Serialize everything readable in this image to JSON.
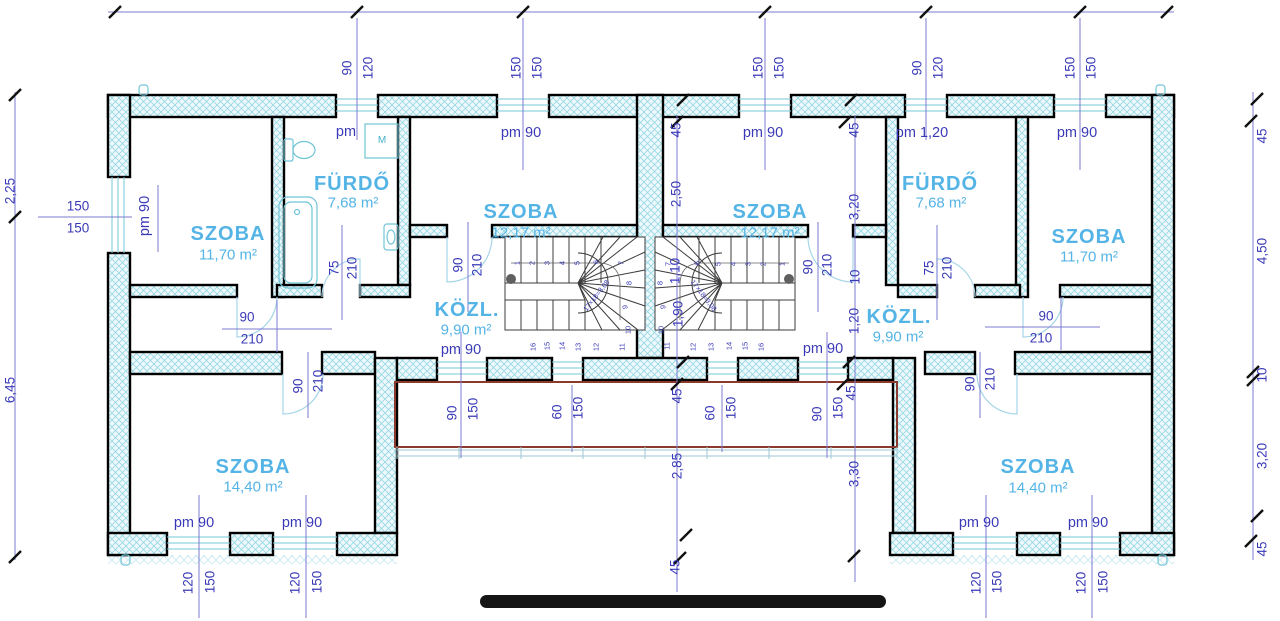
{
  "drawing": {
    "kind": "architectural floor plan",
    "language": "Hungarian",
    "rooms": [
      {
        "name": "SZOBA",
        "area": "11,70 m²"
      },
      {
        "name": "FÜRDŐ",
        "area": "7,68 m²"
      },
      {
        "name": "SZOBA",
        "area": "12,17 m²"
      },
      {
        "name": "KÖZL.",
        "area": "9,90 m²"
      },
      {
        "name": "SZOBA",
        "area": "12,17 m²"
      },
      {
        "name": "KÖZL.",
        "area": "9,90 m²"
      },
      {
        "name": "FÜRDŐ",
        "area": "7,68 m²"
      },
      {
        "name": "SZOBA",
        "area": "11,70 m²"
      },
      {
        "name": "SZOBA",
        "area": "14,40 m²"
      },
      {
        "name": "SZOBA",
        "area": "14,40 m²"
      }
    ],
    "colors": {
      "dimension_text": "#3a3ab8",
      "room_text": "#54b4e6",
      "terrace_outline": "#8a3b2e",
      "wall_hatch": "#96d7e4"
    }
  },
  "labels": [
    {
      "t": "90",
      "x": 347,
      "y": 68,
      "r": -90,
      "c": "dim"
    },
    {
      "t": "120",
      "x": 368,
      "y": 68,
      "r": -90,
      "c": "dim"
    },
    {
      "t": "150",
      "x": 516,
      "y": 68,
      "r": -90,
      "c": "dim"
    },
    {
      "t": "150",
      "x": 537,
      "y": 68,
      "r": -90,
      "c": "dim"
    },
    {
      "t": "150",
      "x": 758,
      "y": 68,
      "r": -90,
      "c": "dim"
    },
    {
      "t": "150",
      "x": 779,
      "y": 68,
      "r": -90,
      "c": "dim"
    },
    {
      "t": "90",
      "x": 917,
      "y": 68,
      "r": -90,
      "c": "dim"
    },
    {
      "t": "120",
      "x": 938,
      "y": 68,
      "r": -90,
      "c": "dim"
    },
    {
      "t": "150",
      "x": 1070,
      "y": 68,
      "r": -90,
      "c": "dim"
    },
    {
      "t": "150",
      "x": 1091,
      "y": 68,
      "r": -90,
      "c": "dim"
    },
    {
      "t": "pm",
      "x": 346,
      "y": 132,
      "c": "pm"
    },
    {
      "t": "pm 90",
      "x": 521,
      "y": 133,
      "c": "pm"
    },
    {
      "t": "pm 90",
      "x": 763,
      "y": 133,
      "c": "pm"
    },
    {
      "t": "pm 1,20",
      "x": 922,
      "y": 133,
      "c": "pm"
    },
    {
      "t": "pm 90",
      "x": 1077,
      "y": 133,
      "c": "pm"
    },
    {
      "t": "pm 90",
      "x": 461,
      "y": 350,
      "c": "pm"
    },
    {
      "t": "pm 90",
      "x": 823,
      "y": 349,
      "c": "pm"
    },
    {
      "t": "pm 90",
      "x": 194,
      "y": 523,
      "c": "pm"
    },
    {
      "t": "pm 90",
      "x": 302,
      "y": 523,
      "c": "pm"
    },
    {
      "t": "pm 90",
      "x": 979,
      "y": 523,
      "c": "pm"
    },
    {
      "t": "pm 90",
      "x": 1088,
      "y": 523,
      "c": "pm"
    },
    {
      "t": "45",
      "x": 676,
      "y": 130,
      "r": -90,
      "c": "dim"
    },
    {
      "t": "45",
      "x": 854,
      "y": 130,
      "r": -90,
      "c": "dim"
    },
    {
      "t": "45",
      "x": 677,
      "y": 396,
      "r": -90,
      "c": "dim"
    },
    {
      "t": "45",
      "x": 851,
      "y": 393,
      "r": -90,
      "c": "dim"
    },
    {
      "t": "45",
      "x": 675,
      "y": 567,
      "r": -90,
      "c": "dim"
    },
    {
      "t": "45",
      "x": 1262,
      "y": 136,
      "r": -90,
      "c": "dim"
    },
    {
      "t": "4,50",
      "x": 1262,
      "y": 251,
      "r": -90,
      "c": "dim"
    },
    {
      "t": "10",
      "x": 1262,
      "y": 375,
      "r": -90,
      "c": "dim"
    },
    {
      "t": "3,20",
      "x": 1262,
      "y": 456,
      "r": -90,
      "c": "dim"
    },
    {
      "t": "45",
      "x": 1262,
      "y": 549,
      "r": -90,
      "c": "dim"
    },
    {
      "t": "2,25",
      "x": 10,
      "y": 191,
      "r": -90,
      "c": "dim"
    },
    {
      "t": "6,45",
      "x": 10,
      "y": 390,
      "r": -90,
      "c": "dim"
    },
    {
      "t": "150",
      "x": 78,
      "y": 206,
      "c": "dim"
    },
    {
      "t": "150",
      "x": 78,
      "y": 228,
      "c": "dim"
    },
    {
      "t": "pm 90",
      "x": 145,
      "y": 216,
      "r": -90,
      "c": "pm"
    },
    {
      "t": "2,50",
      "x": 676,
      "y": 194,
      "r": -90,
      "c": "dim"
    },
    {
      "t": "1,10",
      "x": 675,
      "y": 271,
      "r": -90,
      "c": "dim"
    },
    {
      "t": "1,90",
      "x": 678,
      "y": 314,
      "r": -90,
      "c": "dim"
    },
    {
      "t": "2,85",
      "x": 677,
      "y": 466,
      "r": -90,
      "c": "dim"
    },
    {
      "t": "3,20",
      "x": 854,
      "y": 207,
      "r": -90,
      "c": "dim"
    },
    {
      "t": "10",
      "x": 855,
      "y": 277,
      "r": -90,
      "c": "dim"
    },
    {
      "t": "1,20",
      "x": 854,
      "y": 321,
      "r": -90,
      "c": "dim"
    },
    {
      "t": "3,30",
      "x": 854,
      "y": 474,
      "r": -90,
      "c": "dim"
    },
    {
      "t": "75",
      "x": 334,
      "y": 268,
      "r": -90,
      "c": "dim"
    },
    {
      "t": "210",
      "x": 352,
      "y": 268,
      "r": -90,
      "c": "dim"
    },
    {
      "t": "75",
      "x": 929,
      "y": 268,
      "r": -90,
      "c": "dim"
    },
    {
      "t": "210",
      "x": 947,
      "y": 268,
      "r": -90,
      "c": "dim"
    },
    {
      "t": "90",
      "x": 247,
      "y": 317,
      "c": "dim"
    },
    {
      "t": "210",
      "x": 252,
      "y": 339,
      "c": "dim"
    },
    {
      "t": "90",
      "x": 1046,
      "y": 316,
      "c": "dim"
    },
    {
      "t": "210",
      "x": 1041,
      "y": 338,
      "c": "dim"
    },
    {
      "t": "90",
      "x": 458,
      "y": 265,
      "r": -90,
      "c": "dim"
    },
    {
      "t": "210",
      "x": 477,
      "y": 265,
      "r": -90,
      "c": "dim"
    },
    {
      "t": "90",
      "x": 808,
      "y": 267,
      "r": -90,
      "c": "dim"
    },
    {
      "t": "210",
      "x": 827,
      "y": 265,
      "r": -90,
      "c": "dim"
    },
    {
      "t": "90",
      "x": 298,
      "y": 386,
      "r": -90,
      "c": "dim"
    },
    {
      "t": "210",
      "x": 318,
      "y": 381,
      "r": -90,
      "c": "dim"
    },
    {
      "t": "90",
      "x": 970,
      "y": 384,
      "r": -90,
      "c": "dim"
    },
    {
      "t": "210",
      "x": 990,
      "y": 379,
      "r": -90,
      "c": "dim"
    },
    {
      "t": "90",
      "x": 452,
      "y": 413,
      "r": -90,
      "c": "dim"
    },
    {
      "t": "150",
      "x": 473,
      "y": 409,
      "r": -90,
      "c": "dim"
    },
    {
      "t": "60",
      "x": 557,
      "y": 412,
      "r": -90,
      "c": "dim"
    },
    {
      "t": "150",
      "x": 578,
      "y": 408,
      "r": -90,
      "c": "dim"
    },
    {
      "t": "60",
      "x": 710,
      "y": 413,
      "r": -90,
      "c": "dim"
    },
    {
      "t": "150",
      "x": 731,
      "y": 408,
      "r": -90,
      "c": "dim"
    },
    {
      "t": "90",
      "x": 817,
      "y": 414,
      "r": -90,
      "c": "dim"
    },
    {
      "t": "150",
      "x": 838,
      "y": 408,
      "r": -90,
      "c": "dim"
    },
    {
      "t": "120",
      "x": 188,
      "y": 583,
      "r": -90,
      "c": "dim"
    },
    {
      "t": "150",
      "x": 210,
      "y": 582,
      "r": -90,
      "c": "dim"
    },
    {
      "t": "120",
      "x": 295,
      "y": 583,
      "r": -90,
      "c": "dim"
    },
    {
      "t": "150",
      "x": 317,
      "y": 582,
      "r": -90,
      "c": "dim"
    },
    {
      "t": "120",
      "x": 976,
      "y": 583,
      "r": -90,
      "c": "dim"
    },
    {
      "t": "150",
      "x": 997,
      "y": 582,
      "r": -90,
      "c": "dim"
    },
    {
      "t": "120",
      "x": 1081,
      "y": 583,
      "r": -90,
      "c": "dim"
    },
    {
      "t": "150",
      "x": 1103,
      "y": 582,
      "r": -90,
      "c": "dim"
    },
    {
      "t": "SZOBA",
      "x": 228,
      "y": 234,
      "c": "rt"
    },
    {
      "t": "11,70 m²",
      "x": 228,
      "y": 255,
      "c": "ra"
    },
    {
      "t": "FÜRDŐ",
      "x": 352,
      "y": 184,
      "c": "rt"
    },
    {
      "t": "7,68 m²",
      "x": 353,
      "y": 203,
      "c": "ra"
    },
    {
      "t": "SZOBA",
      "x": 521,
      "y": 212,
      "c": "rt"
    },
    {
      "t": "12,17 m²",
      "x": 521,
      "y": 233,
      "c": "ra"
    },
    {
      "t": "KÖZL.",
      "x": 467,
      "y": 310,
      "c": "rt"
    },
    {
      "t": "9,90 m²",
      "x": 466,
      "y": 330,
      "c": "ra"
    },
    {
      "t": "SZOBA",
      "x": 770,
      "y": 212,
      "c": "rt"
    },
    {
      "t": "12,17 m²",
      "x": 770,
      "y": 233,
      "c": "ra"
    },
    {
      "t": "KÖZL.",
      "x": 899,
      "y": 317,
      "c": "rt"
    },
    {
      "t": "9,90 m²",
      "x": 898,
      "y": 337,
      "c": "ra"
    },
    {
      "t": "FÜRDŐ",
      "x": 940,
      "y": 184,
      "c": "rt"
    },
    {
      "t": "7,68 m²",
      "x": 941,
      "y": 203,
      "c": "ra"
    },
    {
      "t": "SZOBA",
      "x": 1089,
      "y": 237,
      "c": "rt"
    },
    {
      "t": "11,70 m²",
      "x": 1089,
      "y": 257,
      "c": "ra"
    },
    {
      "t": "SZOBA",
      "x": 253,
      "y": 467,
      "c": "rt"
    },
    {
      "t": "14,40 m²",
      "x": 253,
      "y": 487,
      "c": "ra"
    },
    {
      "t": "SZOBA",
      "x": 1038,
      "y": 467,
      "c": "rt"
    },
    {
      "t": "14,40 m²",
      "x": 1038,
      "y": 488,
      "c": "ra"
    },
    {
      "t": "M",
      "x": 382,
      "y": 141,
      "c": "fx"
    },
    {
      "t": "1",
      "x": 517,
      "y": 263,
      "r": -90,
      "c": "tread"
    },
    {
      "t": "2",
      "x": 532,
      "y": 263,
      "r": -90,
      "c": "tread"
    },
    {
      "t": "3",
      "x": 547,
      "y": 263,
      "r": -90,
      "c": "tread"
    },
    {
      "t": "4",
      "x": 562,
      "y": 263,
      "r": -90,
      "c": "tread"
    },
    {
      "t": "5",
      "x": 577,
      "y": 263,
      "r": -90,
      "c": "tread"
    },
    {
      "t": "6",
      "x": 596,
      "y": 262,
      "r": -90,
      "c": "tread"
    },
    {
      "t": "7",
      "x": 621,
      "y": 263,
      "r": -90,
      "c": "tread"
    },
    {
      "t": "8",
      "x": 629,
      "y": 283,
      "r": -90,
      "c": "tread"
    },
    {
      "t": "9",
      "x": 625,
      "y": 307,
      "r": -90,
      "c": "tread"
    },
    {
      "t": "10",
      "x": 628,
      "y": 330,
      "r": -90,
      "c": "tread"
    },
    {
      "t": "11",
      "x": 622,
      "y": 347,
      "r": -90,
      "c": "tread"
    },
    {
      "t": "12",
      "x": 596,
      "y": 347,
      "r": -90,
      "c": "tread"
    },
    {
      "t": "13",
      "x": 578,
      "y": 347,
      "r": -90,
      "c": "tread"
    },
    {
      "t": "14",
      "x": 562,
      "y": 346,
      "r": -90,
      "c": "tread"
    },
    {
      "t": "15",
      "x": 547,
      "y": 346,
      "r": -90,
      "c": "tread"
    },
    {
      "t": "16",
      "x": 533,
      "y": 347,
      "r": -90,
      "c": "tread"
    },
    {
      "t": "1",
      "x": 782,
      "y": 264,
      "r": -90,
      "c": "tread"
    },
    {
      "t": "2",
      "x": 763,
      "y": 264,
      "r": -90,
      "c": "tread"
    },
    {
      "t": "3",
      "x": 748,
      "y": 264,
      "r": -90,
      "c": "tread"
    },
    {
      "t": "4",
      "x": 733,
      "y": 264,
      "r": -90,
      "c": "tread"
    },
    {
      "t": "5",
      "x": 718,
      "y": 264,
      "r": -90,
      "c": "tread"
    },
    {
      "t": "6",
      "x": 697,
      "y": 263,
      "r": -90,
      "c": "tread"
    },
    {
      "t": "7",
      "x": 668,
      "y": 264,
      "r": -90,
      "c": "tread"
    },
    {
      "t": "8",
      "x": 660,
      "y": 283,
      "r": -90,
      "c": "tread"
    },
    {
      "t": "9",
      "x": 663,
      "y": 307,
      "r": -90,
      "c": "tread"
    },
    {
      "t": "10",
      "x": 661,
      "y": 330,
      "r": -90,
      "c": "tread"
    },
    {
      "t": "11",
      "x": 667,
      "y": 346,
      "r": -90,
      "c": "tread"
    },
    {
      "t": "12",
      "x": 693,
      "y": 347,
      "r": -90,
      "c": "tread"
    },
    {
      "t": "13",
      "x": 711,
      "y": 347,
      "r": -90,
      "c": "tread"
    },
    {
      "t": "14",
      "x": 729,
      "y": 346,
      "r": -90,
      "c": "tread"
    },
    {
      "t": "15",
      "x": 745,
      "y": 346,
      "r": -90,
      "c": "tread"
    },
    {
      "t": "16",
      "x": 761,
      "y": 347,
      "r": -90,
      "c": "tread"
    },
    {
      "t": "17×18=3,08",
      "x": 597,
      "y": 296,
      "r": -52,
      "c": "note"
    },
    {
      "t": "17×18=3,08",
      "x": 703,
      "y": 296,
      "r": 52,
      "c": "note"
    }
  ]
}
